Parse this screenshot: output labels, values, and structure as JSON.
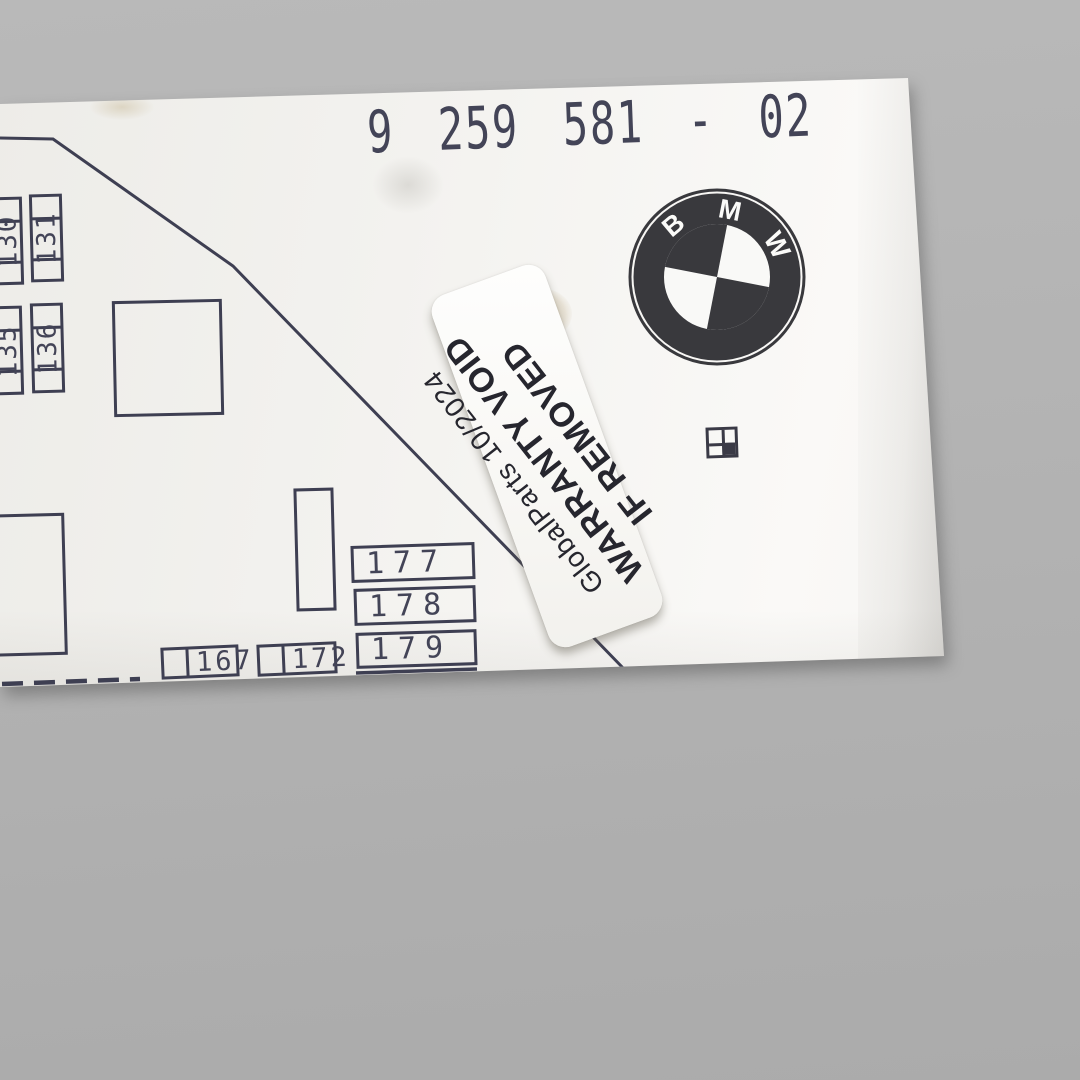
{
  "photo": {
    "description": "BMW module white cover on gray background",
    "background_color": "#b3b3b3",
    "panel_color": "#f3f2ef",
    "ink_color": "#434457",
    "logo_color": "#39393d"
  },
  "part_number": "9 259 581 - 02",
  "logo": {
    "letters": {
      "b": "B",
      "m": "M",
      "w": "W"
    }
  },
  "sticker": {
    "line1": "GlobalParts 10/2024",
    "line2": "WARRANTY VOID",
    "line3": "IF REMOVED"
  },
  "diagram": {
    "vertical_fuses": [
      {
        "label": "130"
      },
      {
        "label": "131"
      },
      {
        "label": "135"
      },
      {
        "label": "136"
      }
    ],
    "row_fuses": [
      {
        "label": "177"
      },
      {
        "label": "178"
      },
      {
        "label": "179"
      }
    ],
    "bottom_fuses": [
      {
        "label": "167"
      },
      {
        "label": "172"
      }
    ]
  }
}
